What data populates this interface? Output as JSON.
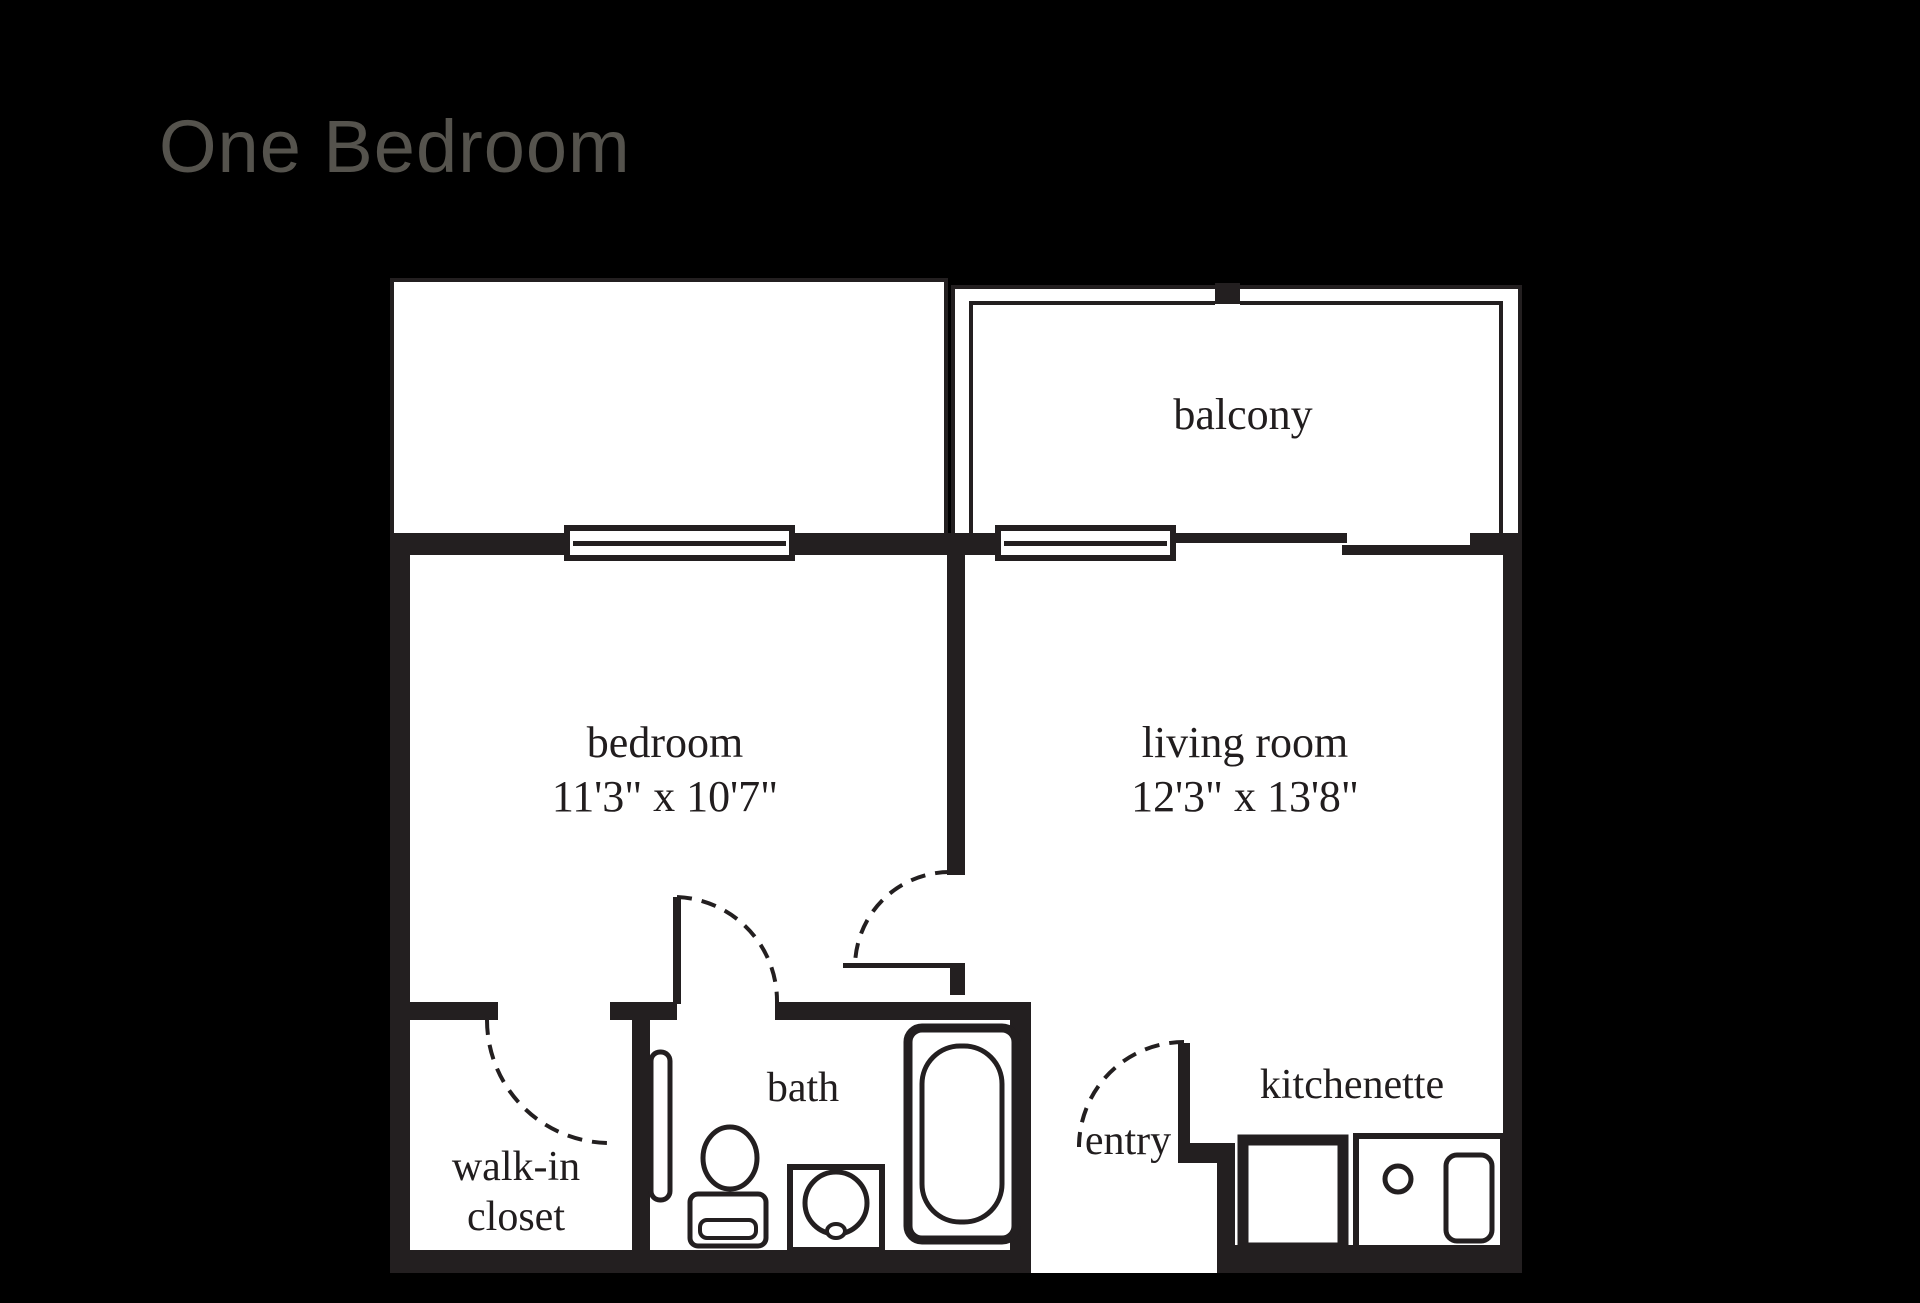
{
  "title": "One Bedroom",
  "colors": {
    "background": "#000000",
    "floor": "#ffffff",
    "wall": "#231f20",
    "title_text": "#55534d",
    "label_text": "#211d1e"
  },
  "rooms": {
    "balcony": {
      "label": "balcony"
    },
    "bedroom": {
      "label": "bedroom",
      "dimensions": "11'3\" x 10'7\""
    },
    "living_room": {
      "label": "living room",
      "dimensions": "12'3\" x 13'8\""
    },
    "bath": {
      "label": "bath"
    },
    "walk_in_closet": {
      "label_line1": "walk-in",
      "label_line2": "closet"
    },
    "entry": {
      "label": "entry"
    },
    "kitchenette": {
      "label": "kitchenette"
    }
  }
}
